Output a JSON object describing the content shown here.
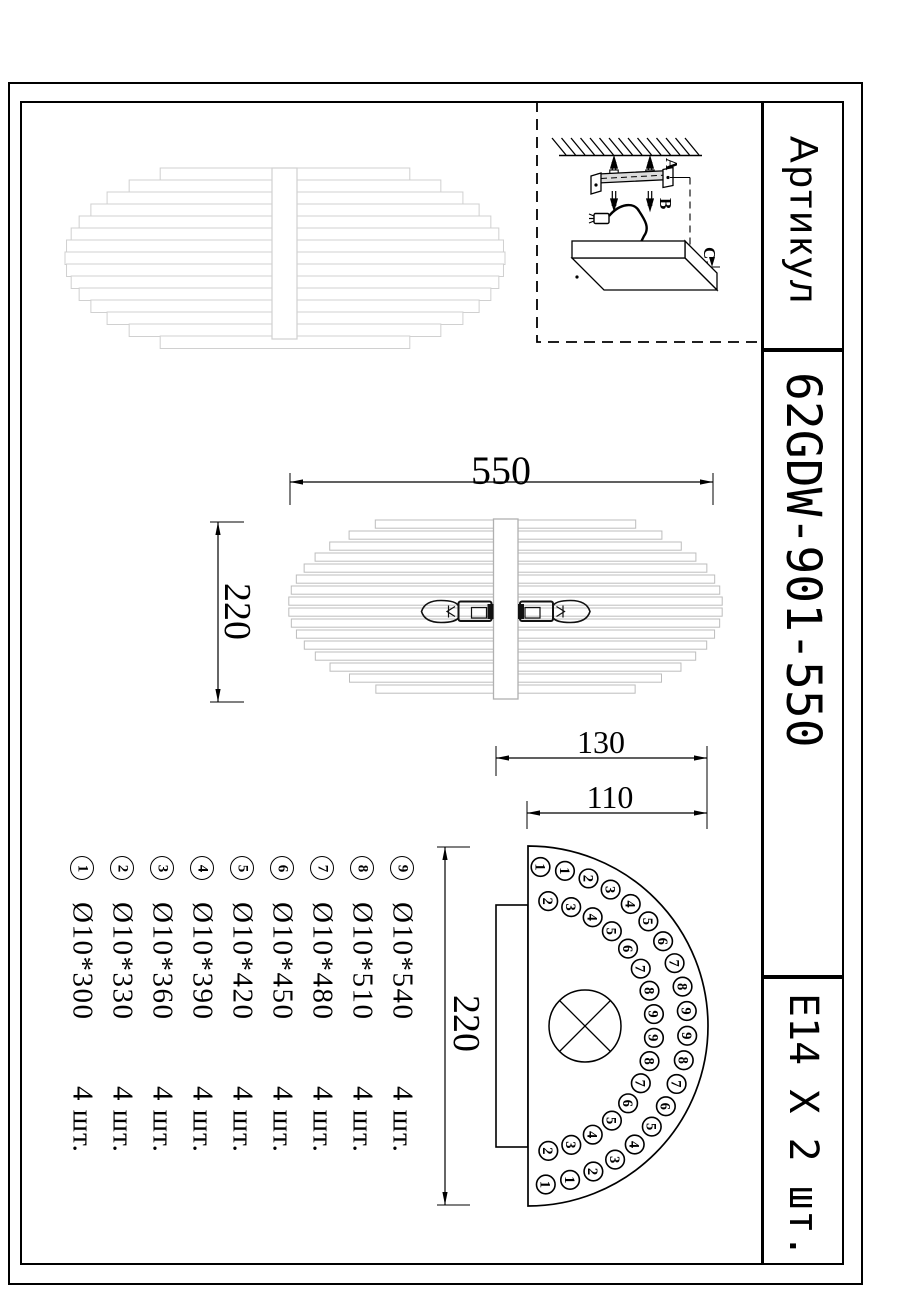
{
  "side_panel": {
    "artikul_label": "Артикул",
    "article_number": "62GDW-901-550",
    "socket_spec": "E14 X 2 шт."
  },
  "dimensions": {
    "lamp_width": "550",
    "lamp_side_height": "220",
    "mount_width_outer": "130",
    "mount_width_inner": "110",
    "section_height": "220"
  },
  "installation": {
    "label_a": "A",
    "label_b": "B",
    "label_c": "C"
  },
  "parts_list": [
    {
      "num": "1",
      "spec": "Ø10*300",
      "qty": "4 шт."
    },
    {
      "num": "2",
      "spec": "Ø10*330",
      "qty": "4 шт."
    },
    {
      "num": "3",
      "spec": "Ø10*360",
      "qty": "4 шт."
    },
    {
      "num": "4",
      "spec": "Ø10*390",
      "qty": "4 шт."
    },
    {
      "num": "5",
      "spec": "Ø10*420",
      "qty": "4 шт."
    },
    {
      "num": "6",
      "spec": "Ø10*450",
      "qty": "4 шт."
    },
    {
      "num": "7",
      "spec": "Ø10*480",
      "qty": "4 шт."
    },
    {
      "num": "8",
      "spec": "Ø10*510",
      "qty": "4 шт."
    },
    {
      "num": "9",
      "spec": "Ø10*540",
      "qty": "4 шт."
    }
  ],
  "section_rings": {
    "outer": [
      "1",
      "1",
      "2",
      "3",
      "4",
      "5",
      "6",
      "7",
      "8",
      "9",
      "9",
      "8",
      "7",
      "6",
      "5",
      "4",
      "3",
      "2",
      "1",
      "1"
    ],
    "inner": [
      "2",
      "3",
      "4",
      "5",
      "6",
      "7",
      "8",
      "9",
      "9",
      "8",
      "7",
      "6",
      "5",
      "4",
      "3",
      "2"
    ]
  },
  "colors": {
    "line": "#000000",
    "light_gray_top_view": "#d0d0d0",
    "light_gray_side_view": "#bdbdbd"
  }
}
